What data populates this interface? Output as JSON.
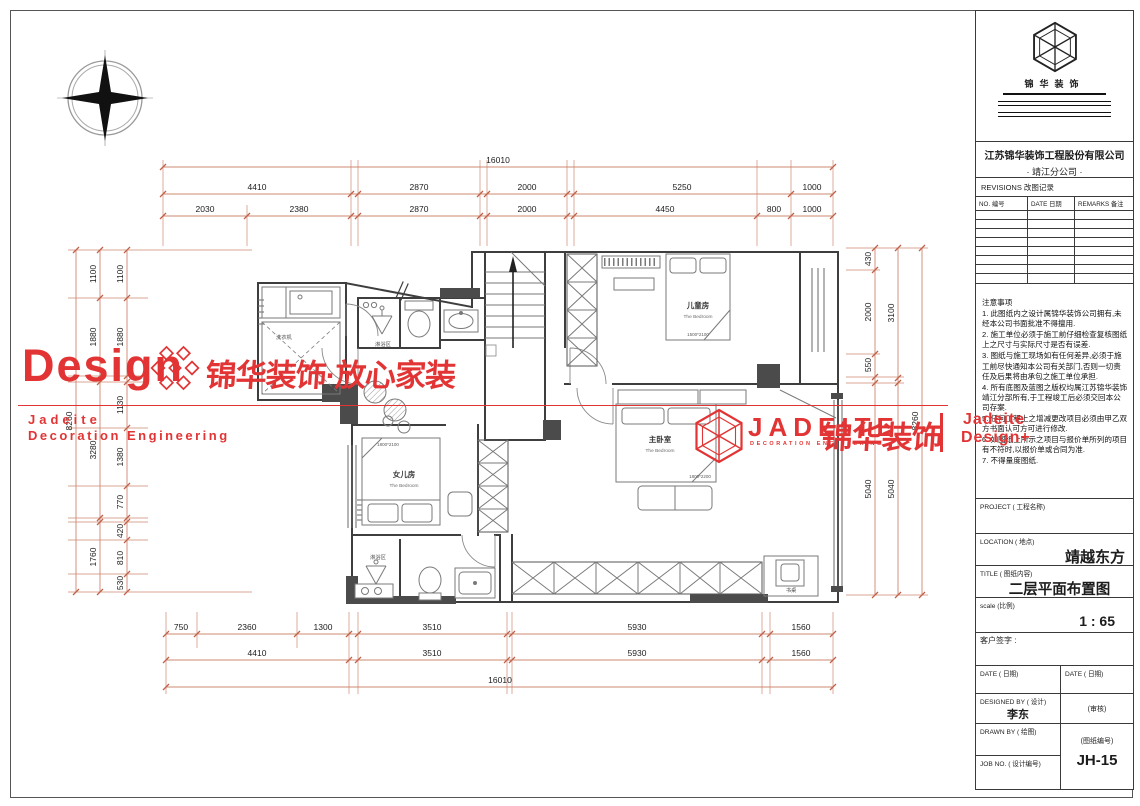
{
  "watermarks": {
    "design": "Design",
    "slogan_cn": "锦华装饰·放心家装",
    "small_brand_line1": "Jadeite",
    "small_brand_line2": "Decoration Engineering",
    "jadeite_en": "JADEITE",
    "jadeite_sub": "DECORATION ENGINEERING",
    "jadeite_cn": "锦华装饰",
    "corner_line1": "Jadeite",
    "corner_line2": "Design+",
    "red": "#e23434"
  },
  "plan": {
    "rooms": {
      "kids": {
        "cn": "儿童房",
        "en": "The Bedroom",
        "size": "1500*2100"
      },
      "master": {
        "cn": "主卧室",
        "en": "The Bedroom",
        "size": "1800*2200"
      },
      "daughter": {
        "cn": "女儿房",
        "en": "The Bedroom",
        "size": "1800*2100"
      }
    },
    "labels": {
      "shower": "淋浴区",
      "washer": "洗衣机",
      "desk": "书桌"
    }
  },
  "dims": {
    "top": {
      "total": "16010",
      "row2": [
        "4410",
        "2870",
        "2000",
        "5250",
        "1000"
      ],
      "row3": [
        "2030",
        "2380",
        "2870",
        "2000",
        "4450",
        "800",
        "1000"
      ]
    },
    "bottom": {
      "row1": [
        "750",
        "2360",
        "1300",
        "3510",
        "5930",
        "1560"
      ],
      "row2": [
        "4410",
        "3510",
        "5930",
        "1560"
      ],
      "total": "16010"
    },
    "left": {
      "total": "8260",
      "mid": [
        "1100",
        "1880",
        "3280",
        "1760"
      ],
      "inner": [
        "1100",
        "1880",
        "1130",
        "1380",
        "770",
        "420",
        "810",
        "530"
      ]
    },
    "right": {
      "total": "8260",
      "mid": [
        "3100",
        "5040"
      ],
      "inner": [
        "430",
        "2000",
        "550",
        "5040"
      ]
    }
  },
  "title_block": {
    "logo_cn": "锦华装饰",
    "company": "江苏锦华装饰工程股份有限公司",
    "branch": "· 靖江分公司 ·",
    "revisions_label": "REVISIONS    改图记录",
    "rev_col_no": "NO. 编号",
    "rev_col_date": "DATE 日期",
    "rev_col_remarks": "REMARKS 备注",
    "notes_title": "注意事项",
    "notes": [
      "1. 此图纸内之设计属锦华装饰公司拥有,未经本公司书面批准不得擅用.",
      "2. 施工单位必须于施工前仔细检查复核图纸上之尺寸与实际尺寸是否有误差.",
      "3. 图纸与施工现场如有任何差异,必须于施工前尽快通知本公司有关部门,否则一切责任及后果将由承包之施工单位承担.",
      "4. 所有底图及蓝图之版权均属江苏锦华装饰靖江分部所有,于工程竣工后必须交回本公司存案.",
      "5. 任何工程上之增减更改项目必须由甲乙双方书面认可方可进行修改.",
      "6. 如图纸上所示之项目与报价单所列的项目有不符时,以报价单或合同为准.",
      "7. 不得量度图纸."
    ],
    "project_label": "PROJECT (  工程名称)",
    "location_label": "LOCATION (  地点)",
    "location_value": "靖越东方",
    "title_label": "TITLE (  图纸内容)",
    "title_value": "二层平面布置图",
    "scale_label": "scale (比例)",
    "scale_value": "1 : 65",
    "client_sign_label": "客户签字 :",
    "date_label_1": "DATE (  日期)",
    "date_label_2": "DATE (  日期)",
    "designed_by_label": "DESIGNED BY (   设计)",
    "designer": "李东",
    "checker_label": "(审核)",
    "drawn_by_label": "DRAWN BY (  绘图)",
    "drawing_no_label": "(图纸编号)",
    "job_no_label": "JOB NO. (  设计编号)",
    "job_no": "JH-15"
  }
}
